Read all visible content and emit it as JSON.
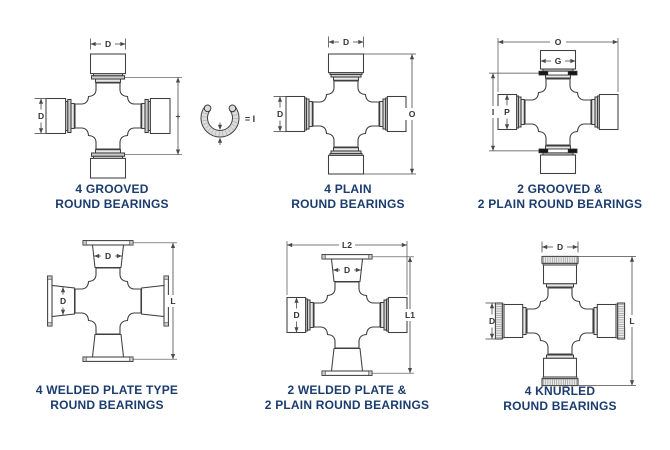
{
  "page": {
    "background": "#ffffff"
  },
  "colors": {
    "title": "#1b3c6e",
    "line": "#3f3f3f",
    "dim": "#4a4a4a",
    "ring_light": "#e9e9e9",
    "ring_mid": "#cfcfcf",
    "snap_ring_black": "#161616",
    "knurl": "#e8e8e8"
  },
  "diagrams": [
    {
      "id": "grooved-4",
      "title_lines": [
        "4 GROOVED",
        "ROUND BEARINGS"
      ],
      "bearings": {
        "top": "grooved",
        "right": "grooved",
        "bottom": "grooved",
        "left": "grooved"
      },
      "dimensions": [
        {
          "label": "D",
          "measures": "cup-width-top"
        },
        {
          "label": "D",
          "measures": "cup-width-left"
        },
        {
          "label": "+",
          "measures": "groove-to-groove-height"
        },
        {
          "label": "= I",
          "measures": "height-plus-snap-ring",
          "icon": "snap-ring-icon"
        }
      ]
    },
    {
      "id": "plain-4",
      "title_lines": [
        "4 PLAIN",
        "ROUND BEARINGS"
      ],
      "bearings": {
        "top": "plain",
        "right": "plain",
        "bottom": "plain",
        "left": "plain"
      },
      "dimensions": [
        {
          "label": "D",
          "measures": "cup-width-top"
        },
        {
          "label": "D",
          "measures": "cup-width-left"
        },
        {
          "label": "O",
          "measures": "overall-height"
        }
      ]
    },
    {
      "id": "grooved-2-plain-2",
      "title_lines": [
        "2 GROOVED &",
        "2 PLAIN ROUND BEARINGS"
      ],
      "bearings": {
        "top": "grooved-snap",
        "right": "plain",
        "bottom": "grooved-snap",
        "left": "plain"
      },
      "dimensions": [
        {
          "label": "O",
          "measures": "overall-width"
        },
        {
          "label": "G",
          "measures": "cup-bore-top"
        },
        {
          "label": "I",
          "measures": "ring-to-ring-height"
        },
        {
          "label": "P",
          "measures": "cup-bore-left"
        }
      ]
    },
    {
      "id": "welded-plate-4",
      "title_lines": [
        "4 WELDED PLATE TYPE",
        "ROUND BEARINGS"
      ],
      "bearings": {
        "top": "plate",
        "right": "plate",
        "bottom": "plate",
        "left": "plate"
      },
      "dimensions": [
        {
          "label": "D",
          "measures": "cup-width-top"
        },
        {
          "label": "D",
          "measures": "cup-width-left"
        },
        {
          "label": "L",
          "measures": "plate-to-plate-height"
        }
      ]
    },
    {
      "id": "welded-2-plain-2",
      "title_lines": [
        "2 WELDED PLATE &",
        "2 PLAIN ROUND BEARINGS"
      ],
      "bearings": {
        "top": "plate",
        "right": "plain",
        "bottom": "plate",
        "left": "plain"
      },
      "dimensions": [
        {
          "label": "L2",
          "measures": "overall-width"
        },
        {
          "label": "D",
          "measures": "cup-width-top"
        },
        {
          "label": "D",
          "measures": "cup-width-left"
        },
        {
          "label": "L1",
          "measures": "plate-to-plate-height"
        }
      ]
    },
    {
      "id": "knurled-4",
      "title_lines": [
        "4 KNURLED",
        "ROUND BEARINGS"
      ],
      "bearings": {
        "top": "knurled",
        "right": "knurled",
        "bottom": "knurled",
        "left": "knurled"
      },
      "dimensions": [
        {
          "label": "D",
          "measures": "cup-width-top"
        },
        {
          "label": "D",
          "measures": "cup-width-left"
        },
        {
          "label": "L",
          "measures": "overall-height"
        }
      ]
    }
  ]
}
